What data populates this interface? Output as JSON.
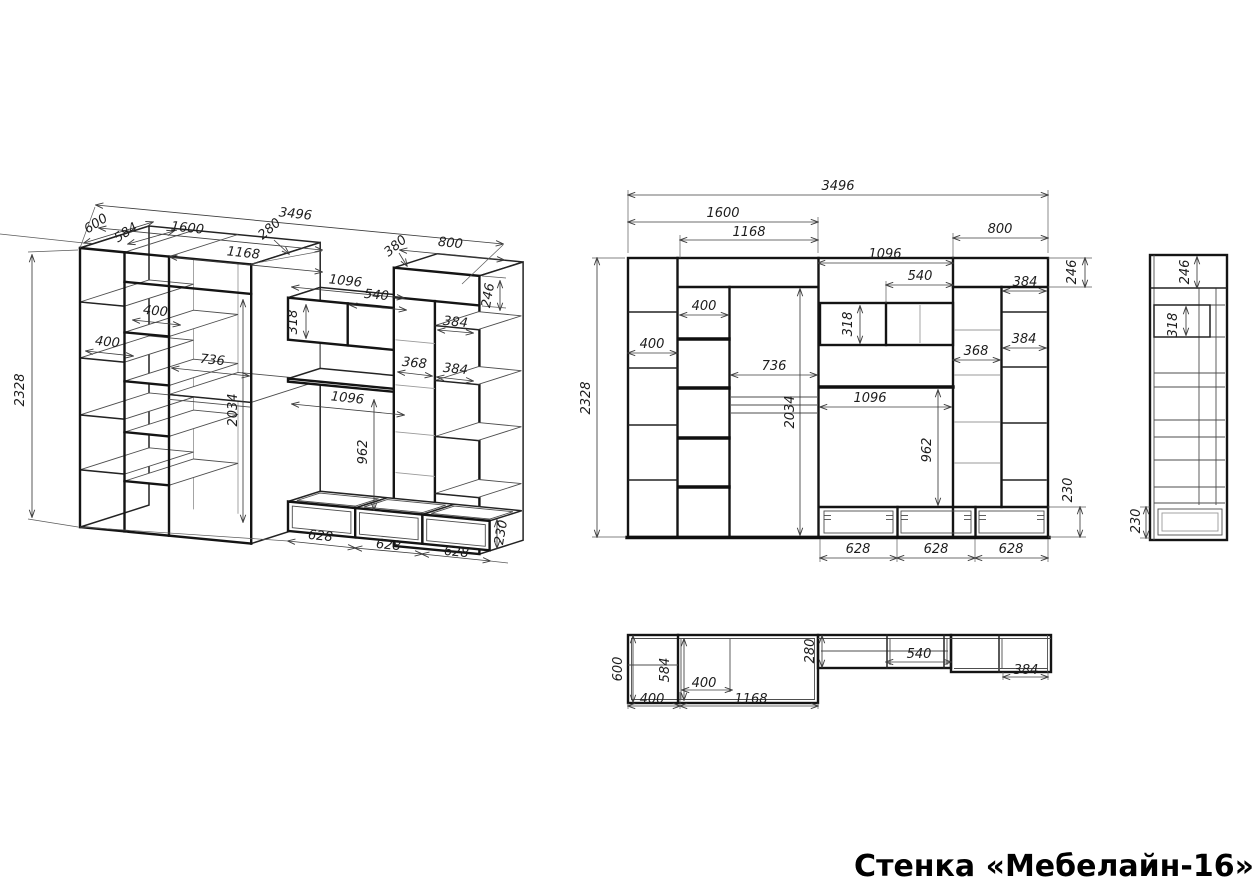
{
  "title": "Стенка «Мебелайн-16»",
  "colors": {
    "background": "#ffffff",
    "line": "#1a1a1a",
    "dim_text": "#1d1d1d"
  },
  "dims": {
    "d230": "230",
    "d246": "246",
    "d280": "280",
    "d318": "318",
    "d368": "368",
    "d380": "380",
    "d384": "384",
    "d400": "400",
    "d540": "540",
    "d584": "584",
    "d600": "600",
    "d628": "628",
    "d736": "736",
    "d800": "800",
    "d962": "962",
    "d1096": "1096",
    "d1168": "1168",
    "d1600": "1600",
    "d2034": "2034",
    "d2328": "2328",
    "d3496": "3496"
  }
}
